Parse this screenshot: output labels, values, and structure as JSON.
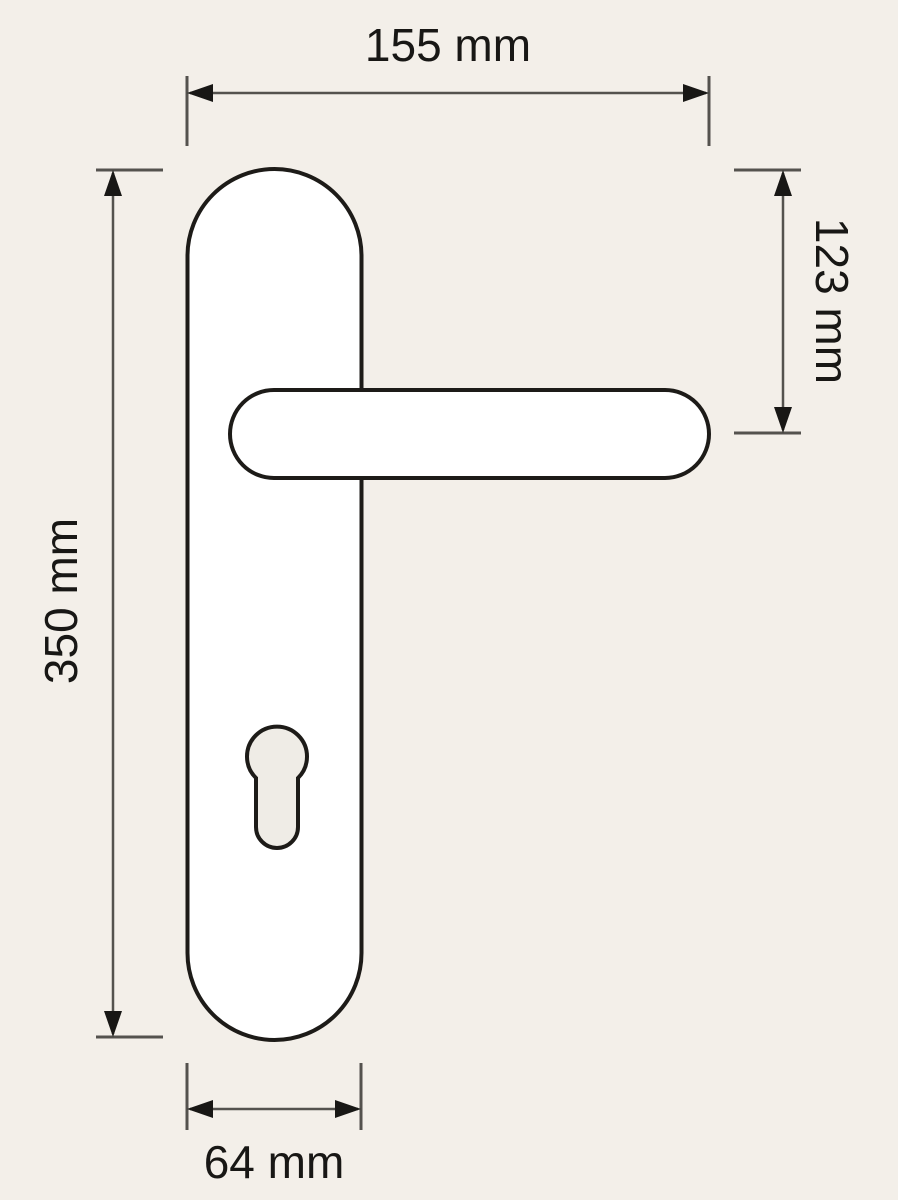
{
  "page": {
    "background_color": "#f3efe9",
    "kind": "technical dimension drawing",
    "subject": "door lever handle on long backplate with euro cylinder keyhole"
  },
  "drawing": {
    "colors": {
      "background": "#f3efe9",
      "shape_fill": "#ffffff",
      "keyhole_fill": "#efece6",
      "outline": "#1d1b18",
      "dimension_line": "#54524e",
      "arrow_and_text": "#181715"
    },
    "dimensions": {
      "total_width": "155 mm",
      "top_to_handle_axis": "123 mm",
      "plate_height": "350 mm",
      "plate_width": "64 mm"
    }
  }
}
